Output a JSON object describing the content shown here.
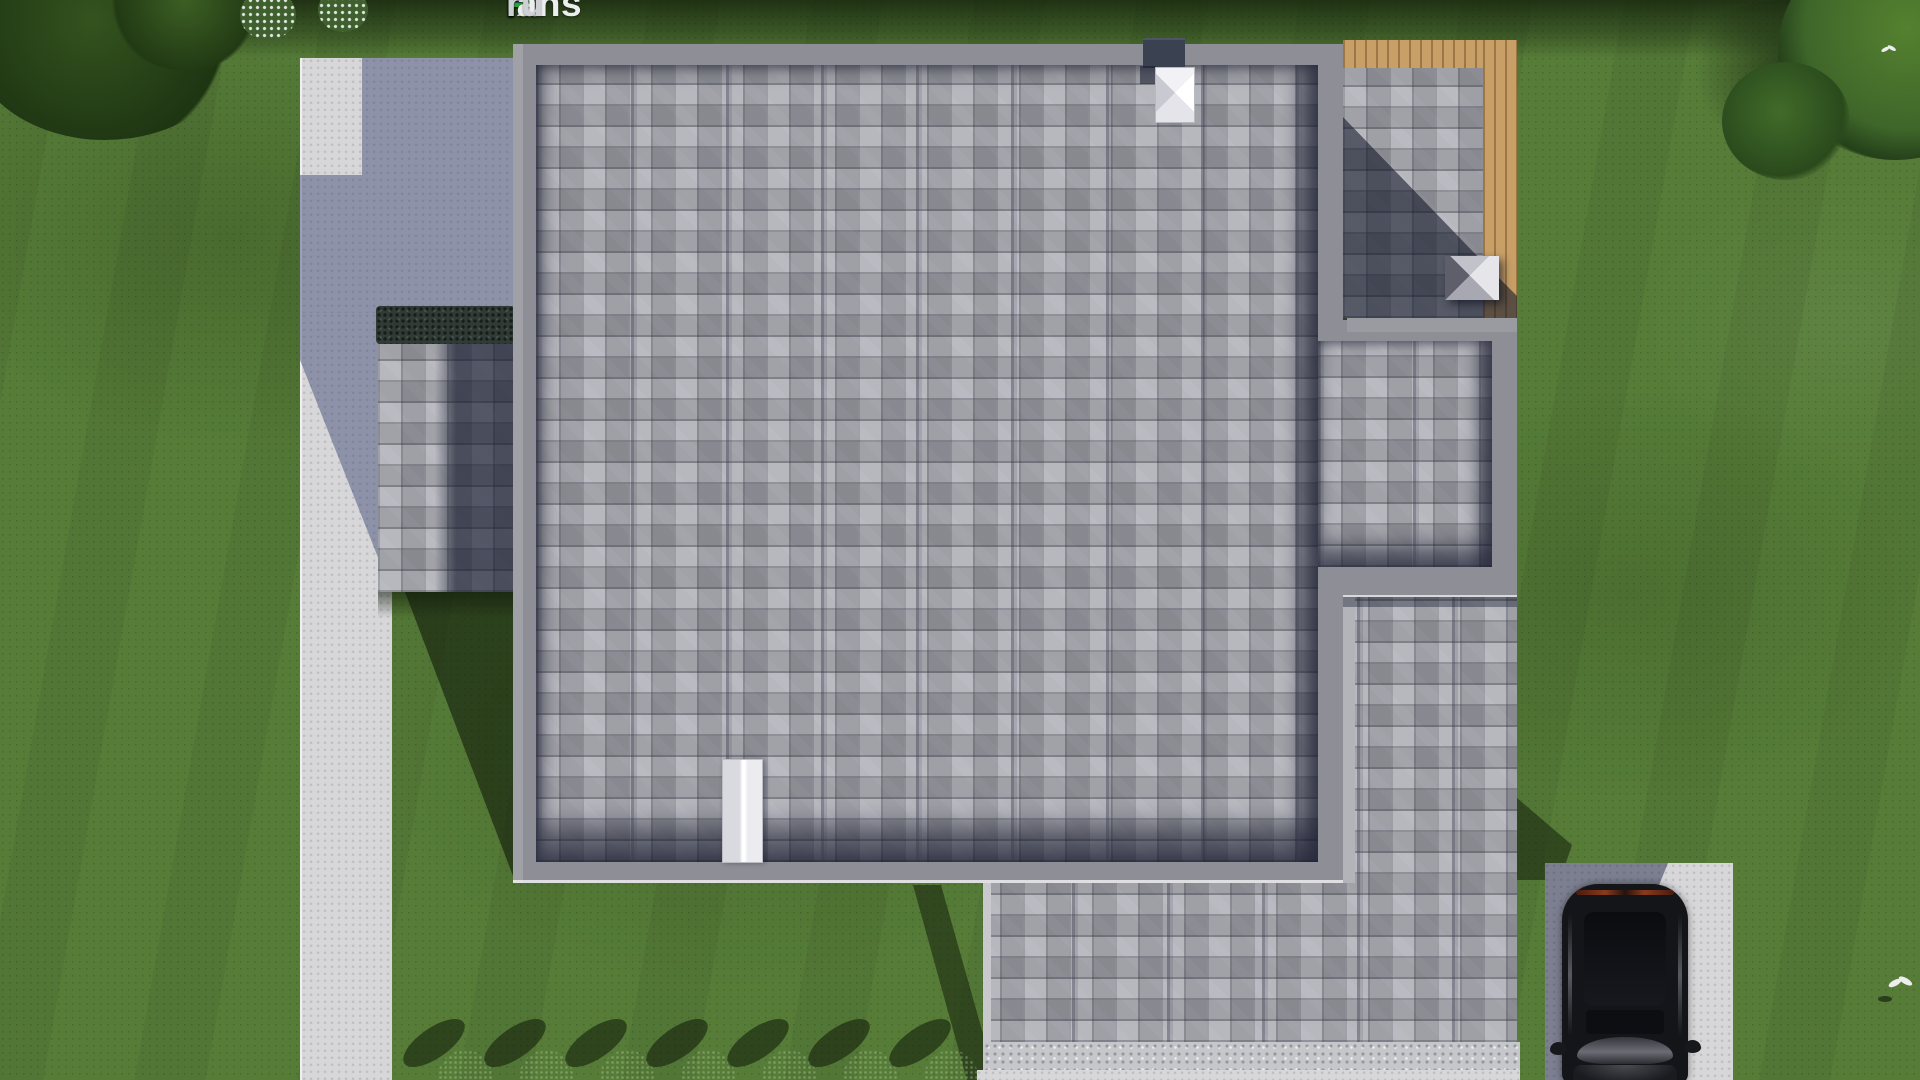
{
  "watermark": {
    "parts": [
      {
        "text": "F",
        "color": "#3575cf"
      },
      {
        "text": "ix",
        "color": "#eceef0"
      },
      {
        "text": "P",
        "color": "#2fa43e"
      },
      {
        "text": "lans",
        "color": "#eceef0"
      },
      {
        "text": ".",
        "color": "#3575cf"
      },
      {
        "text": "ru",
        "color": "#cfd0d3"
      }
    ]
  },
  "palette": {
    "grass": "#567c38",
    "grass-shadow": "#1a2c0e",
    "concrete": "#d7d7d9",
    "concrete-shadow": "#3a4270",
    "shingle": "#a7a8b0",
    "shingle-shadow": "#141c30",
    "parapet": "#8e8f96",
    "parapet-light": "#c9c9cd",
    "wood": "#c79f67",
    "stone": "#c6c7cb",
    "hedge": "#313b35",
    "chimney-dark": "#3a4150",
    "chimney-white": "#f4f4f6",
    "car": "#141518",
    "car-reflect": "#6b6c74",
    "bush": "#2c4a1f",
    "canopy": "#3f662a",
    "flower": "#eef0ea"
  },
  "scene": {
    "description": "Aerial top-down 3D render of a house: gray shingled flat roof with parapets, wood deck at top-right, detached annex roof at left, concrete pad and walkway on the left, lower garage wing with gravel path at bottom, driveway with black SUV at bottom-right, lawn with bushes, trees and two white birds; FixPlans.ru watermark at top.",
    "objects": [
      "main-roof",
      "left-annex-roof",
      "top-right-deck",
      "right-roof-bay",
      "lower-roof-wing",
      "white-chimney",
      "dark-chimney",
      "white-skylight",
      "gray-roof-vent",
      "concrete-pad",
      "walkway",
      "gravel-path",
      "driveway",
      "black-suv-car",
      "bush-row",
      "flowering-bushes",
      "trees",
      "white-bird-on-lawn",
      "white-bird-in-tree"
    ]
  }
}
